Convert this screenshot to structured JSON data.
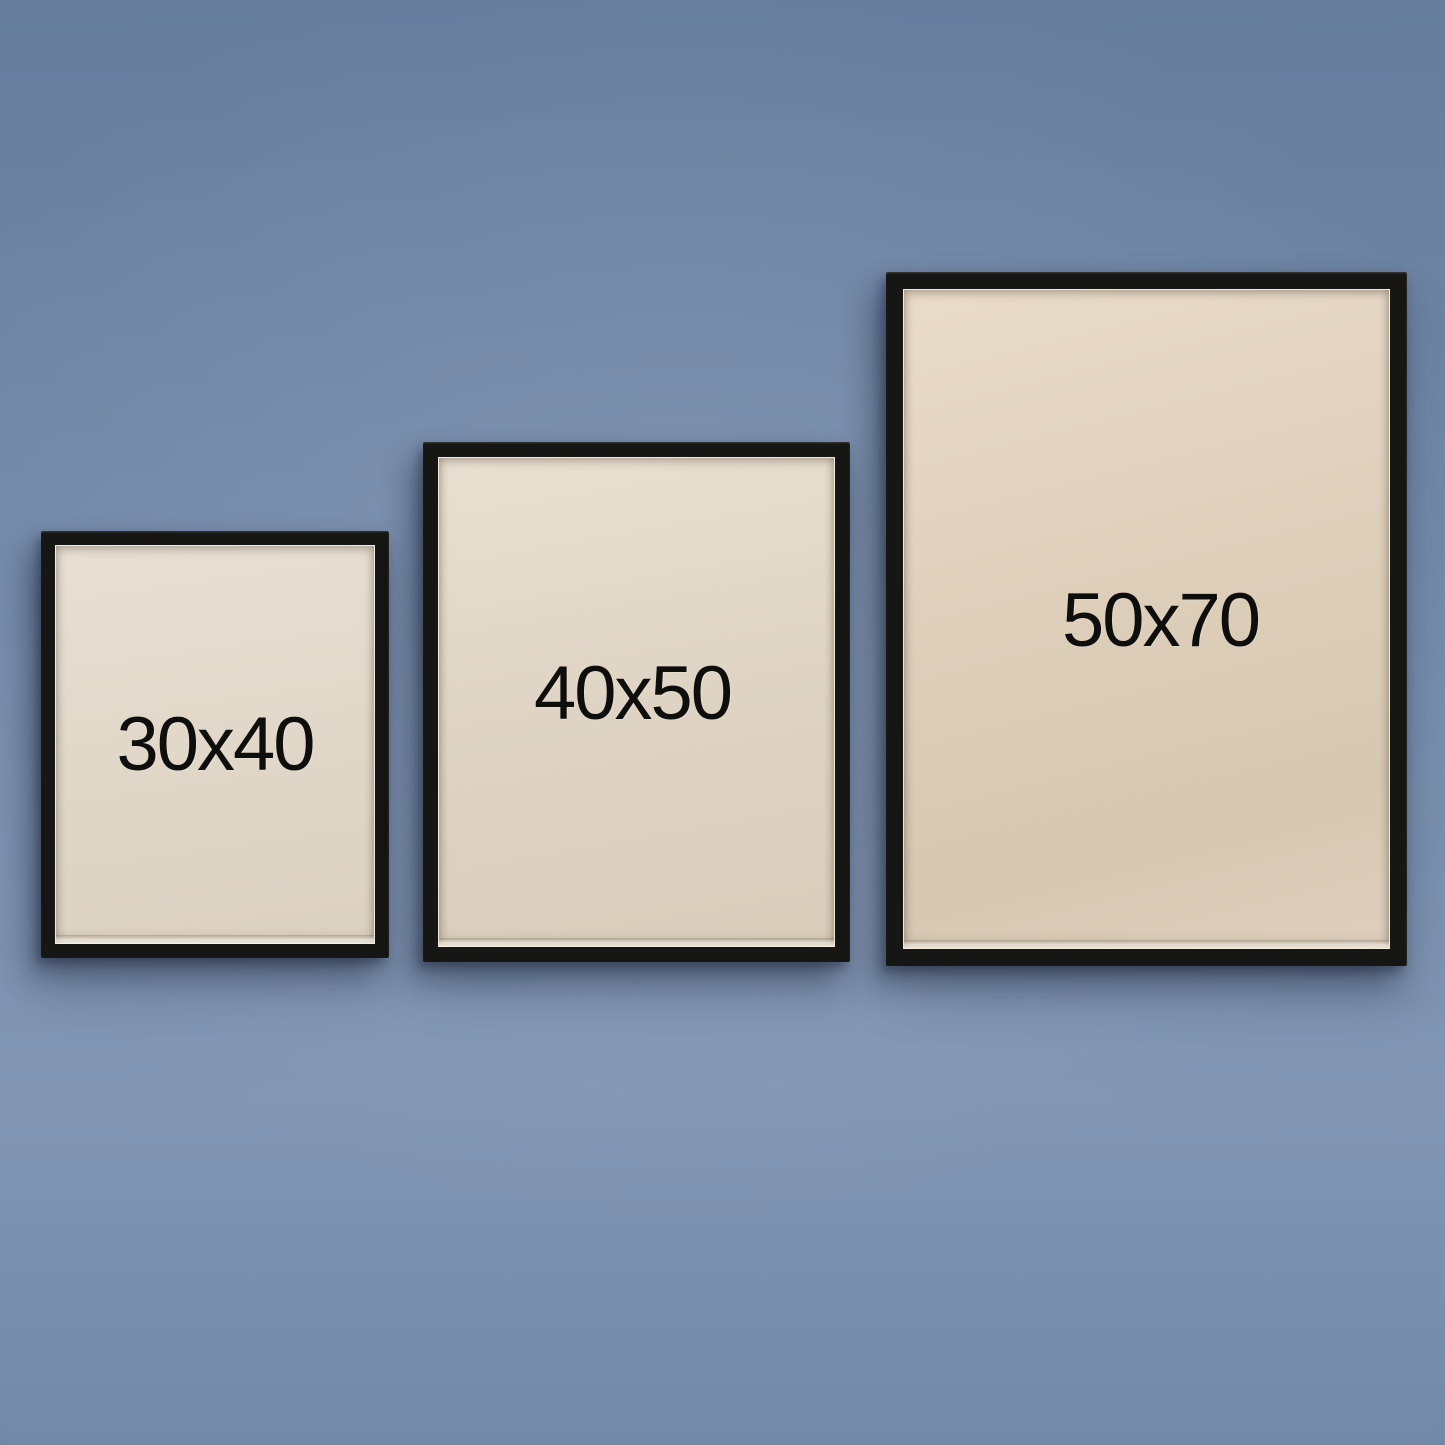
{
  "scene": {
    "kind": "poster-frame-size-comparison-photo",
    "wall": "plain painted wall, soft vignette",
    "frame_style": "thin black wooden frame with warm off-white blank paper"
  },
  "colors": {
    "wall": "#7389a9",
    "wall_light": "#8296b4",
    "wall_dark": "#667d9e",
    "frame_black": "#161614",
    "paper": "#e2d8c8",
    "paper_light": "#eae2d2",
    "paper_dark": "#d5c7b3",
    "label_text": "#0e0e0d"
  },
  "frames": [
    {
      "label": "30x40"
    },
    {
      "label": "40x50"
    },
    {
      "label": "50x70"
    }
  ]
}
